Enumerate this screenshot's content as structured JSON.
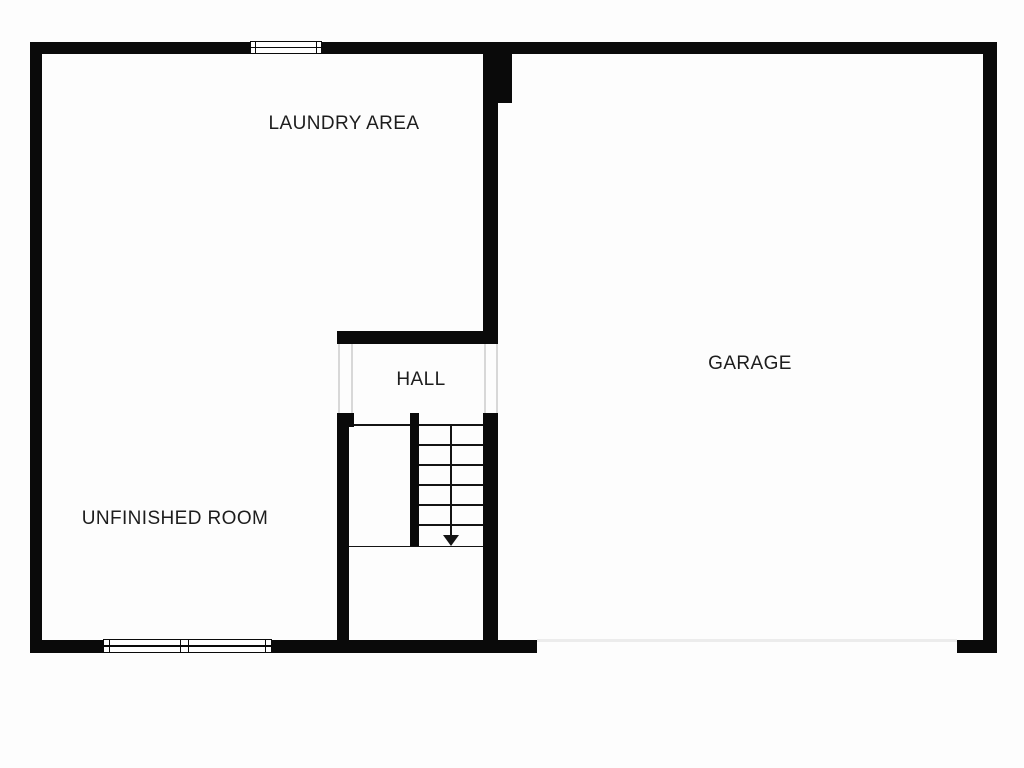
{
  "floor_plan": {
    "type": "residential-basement-floor-plan",
    "labels": {
      "laundry": "LAUNDRY AREA",
      "garage": "GARAGE",
      "hall": "HALL",
      "unfinished_room": "UNFINISHED ROOM"
    },
    "stairs": {
      "direction": "down",
      "tread_count": 6
    },
    "colors": {
      "wall": "#0a0a0a",
      "line": "#141414",
      "faint": "#d8d8d8",
      "garage_door": "#ececec",
      "text": "#1d1d1d",
      "background": "#fdfdfd"
    }
  }
}
